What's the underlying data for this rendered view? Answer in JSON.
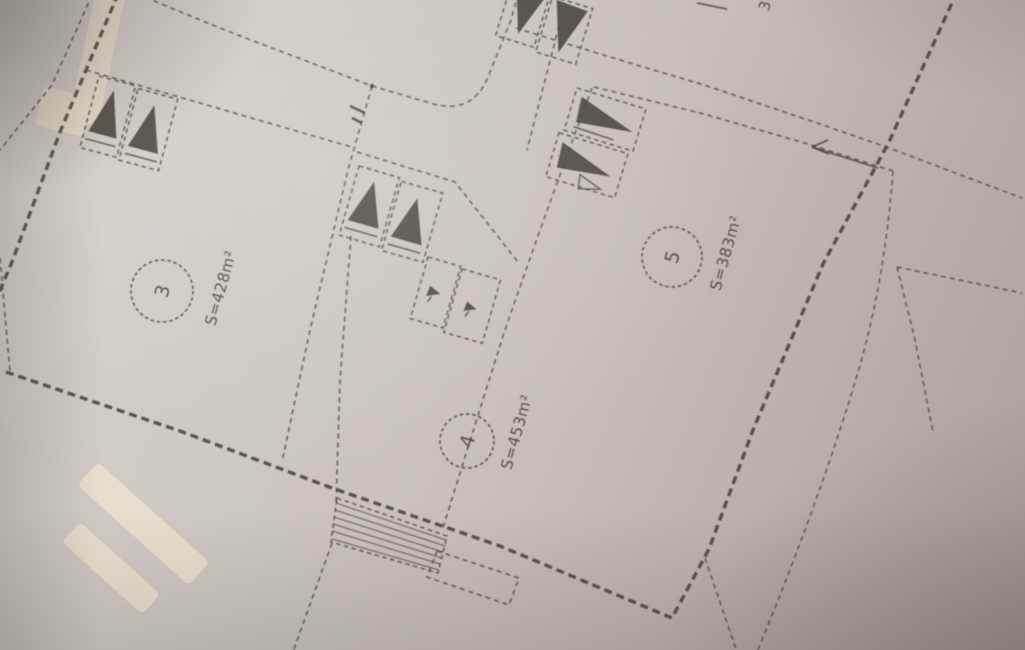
{
  "plan": {
    "plots": [
      {
        "number": "3",
        "area": "S=428m²"
      },
      {
        "number": "4",
        "area": "S=453m²"
      },
      {
        "number": "5",
        "area": "S=383m²"
      }
    ],
    "edge_label_fragment": "3"
  },
  "colors": {
    "paper_light": "#d8d3ce",
    "paper_dark": "#a9a29a",
    "ink": "#4f4942",
    "ink_thick": "#443f39",
    "symbol_fill": "#45403a",
    "tape": "#ebe3cf"
  },
  "symbols": {
    "entrance_marker": "triangle-in-box",
    "hatch_area": "stair-hatch",
    "tape_highlight": "cream-tape"
  }
}
